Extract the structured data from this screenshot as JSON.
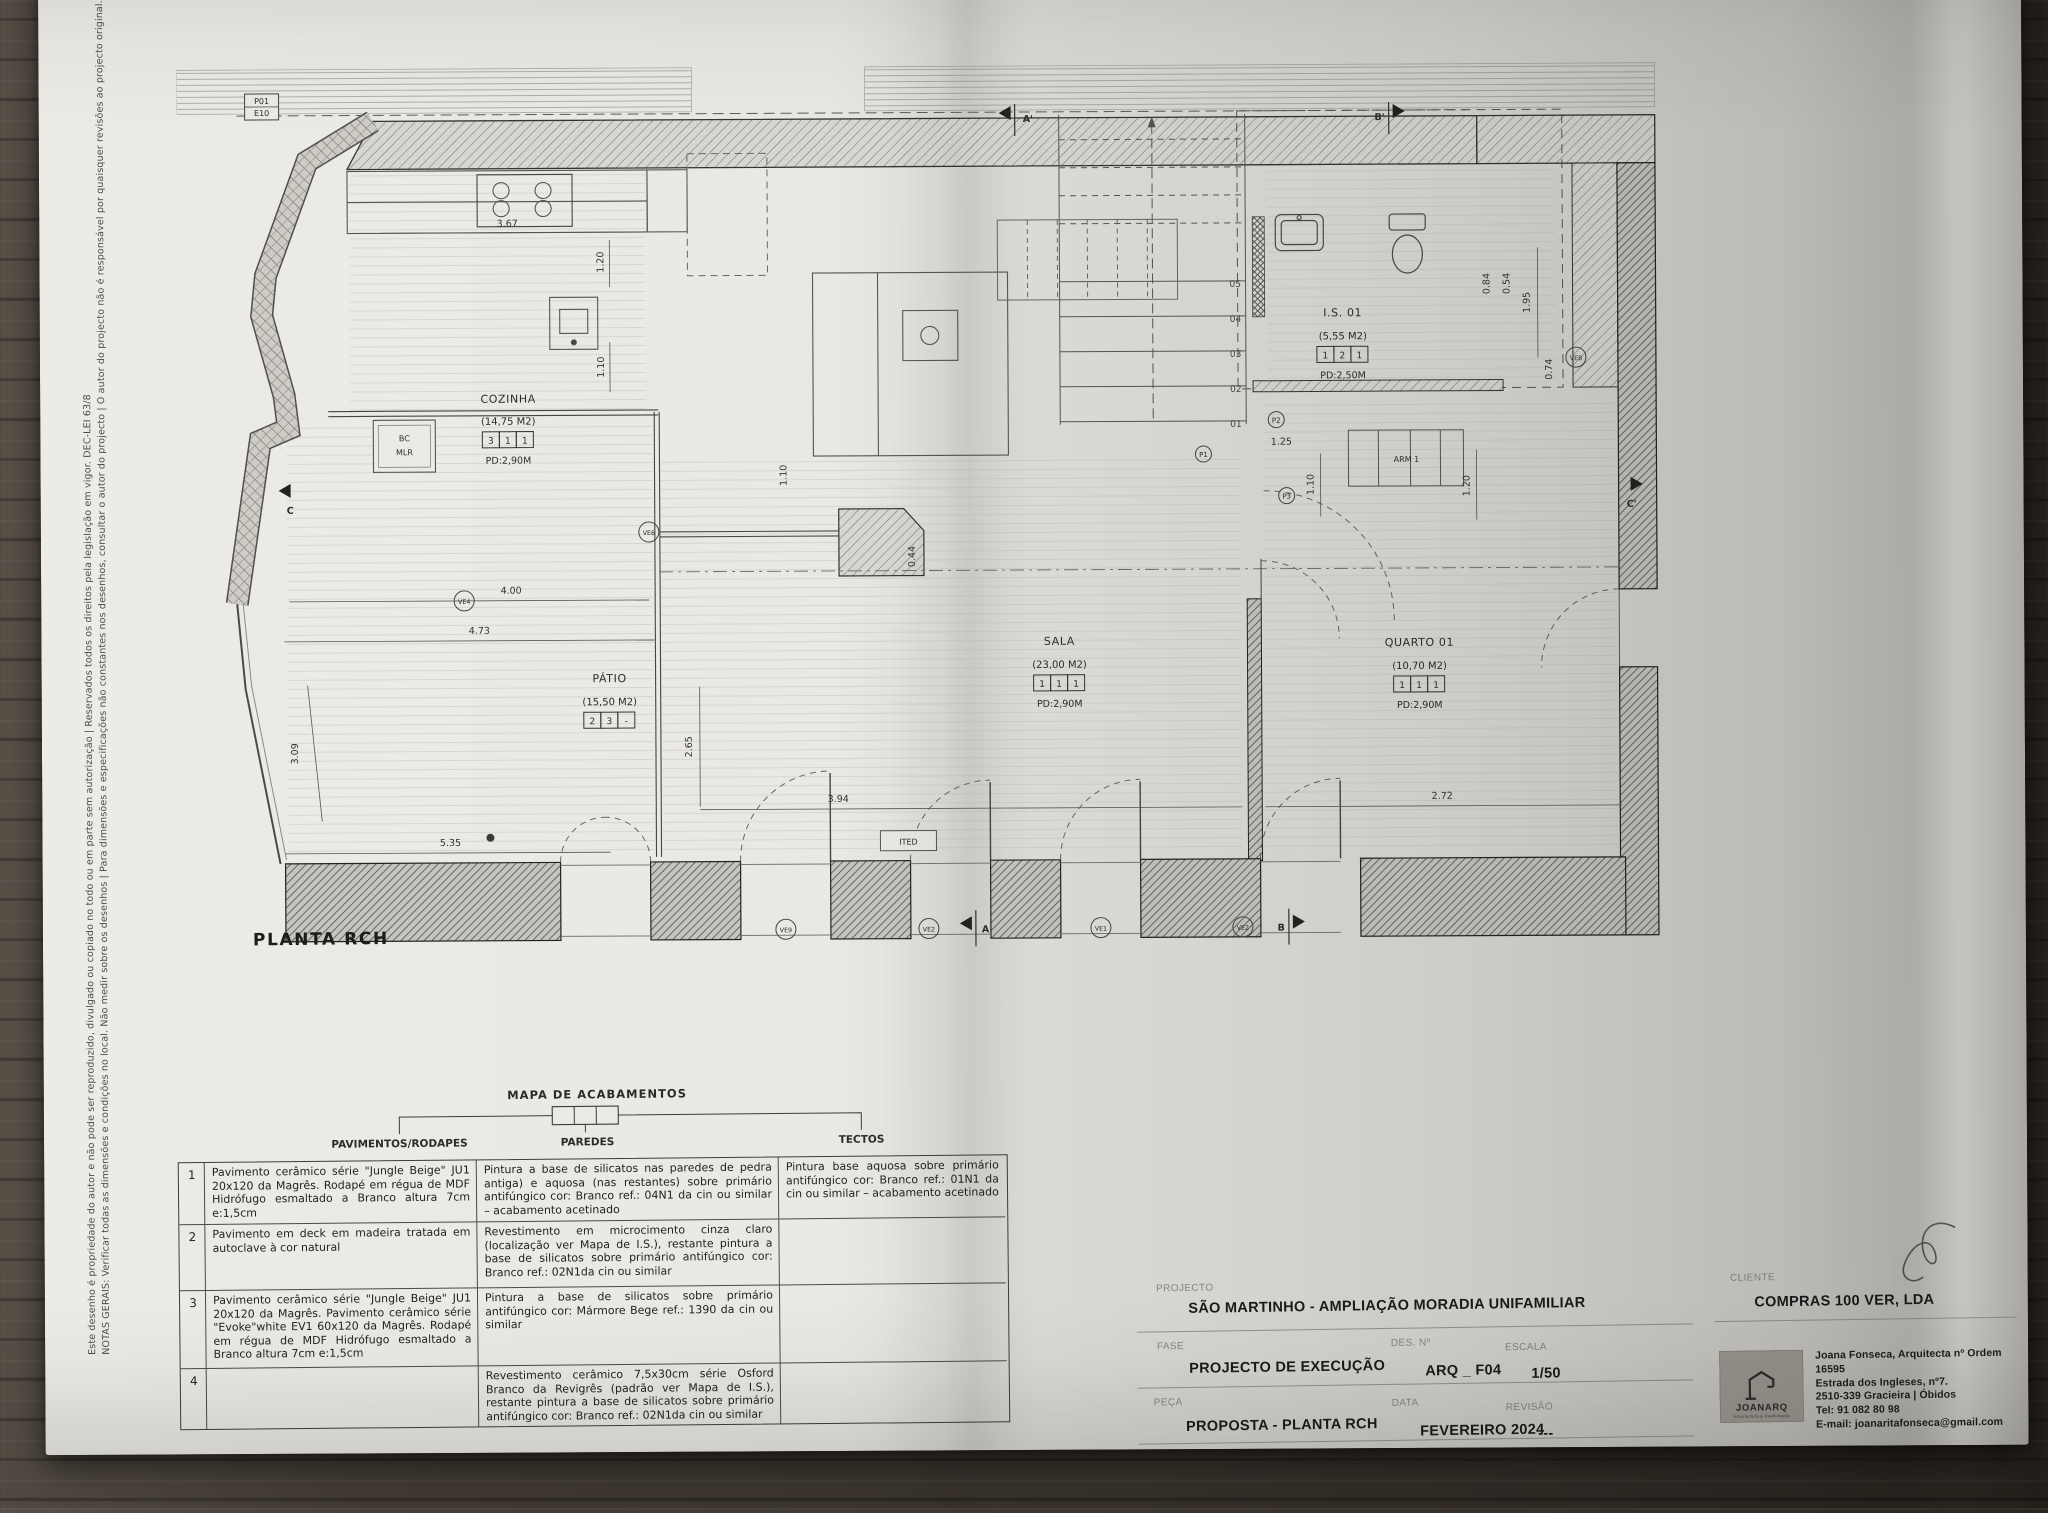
{
  "notes": {
    "line1": "NOTAS GERAIS: Verificar todas as dimensões e condições no local. Não medir sobre os desenhos | Para dimensões e especificações não constantes nos desenhos, consultar o autor do projecto | O autor do projecto não é responsável por quaisquer revisões ao projecto original.",
    "line2": "Este desenho é propriedade do autor e não pode ser reproduzido, divulgado ou copiado no todo ou em parte sem autorização | Reservados todos os direitos pela legislação em vigor. DEC-LEI 63/8"
  },
  "plan": {
    "title": "PLANTA RCH",
    "rooms": [
      {
        "name": "COZINHA",
        "area": "(14,75 M2)",
        "codes": [
          "3",
          "1",
          "1"
        ],
        "pd": "PD:2,90M"
      },
      {
        "name": "PÁTIO",
        "area": "(15,50 M2)",
        "codes": [
          "2",
          "3",
          "-"
        ],
        "pd": ""
      },
      {
        "name": "SALA",
        "area": "(23,00 M2)",
        "codes": [
          "1",
          "1",
          "1"
        ],
        "pd": "PD:2,90M"
      },
      {
        "name": "QUARTO 01",
        "area": "(10,70 M2)",
        "codes": [
          "1",
          "1",
          "1"
        ],
        "pd": "PD:2,90M"
      },
      {
        "name": "I.S. 01",
        "area": "(5,55 M2)",
        "codes": [
          "1",
          "2",
          "1"
        ],
        "pd": "PD:2,50M"
      }
    ],
    "arm_label": "ARM 1",
    "bc_label": "BC",
    "mlr_label": "MLR",
    "ited_label": "ITED",
    "dims": {
      "kitchen_w": "3.67",
      "kitchen_v1": "1.20",
      "kitchen_v2": "1.10",
      "patio_glass": "4.00",
      "patio_w": "4.73",
      "patio_h": "2.65",
      "patio_left": "3.09",
      "patio_b": "5.35",
      "sala_w": "3.94",
      "quarto_w": "2.72",
      "hall_w": "1.25",
      "hall_v": "1.10",
      "arm_v": "1.20",
      "is_v": "1.95",
      "is_d1": "0.84",
      "is_d2": "0.54",
      "is_d3": "0.74",
      "wall_d": "0.44",
      "mid_v": "1.10"
    },
    "stairs": [
      "05",
      "04",
      "03",
      "02",
      "01"
    ],
    "markers": {
      "ve4": "VE4",
      "ve6": "VE6",
      "ve8": "VE8",
      "ve9": "VE9",
      "ve2a": "VE2",
      "ve1": "VE1",
      "ve2b": "VE2",
      "p1": "P1",
      "p2": "P2",
      "p3": "P3"
    },
    "refs": {
      "p01": "P01",
      "e10": "E10",
      "p02": "P02",
      "e11": "E11"
    },
    "sections": {
      "a": "A",
      "a_prime": "A'",
      "b": "B",
      "b_prime": "B'",
      "c": "C",
      "c_prime": "C'"
    }
  },
  "finishes": {
    "title": "MAPA DE ACABAMENTOS",
    "columns": [
      "PAVIMENTOS/RODAPES",
      "PAREDES",
      "TECTOS"
    ],
    "rows": [
      {
        "num": "1",
        "pavimentos": "Pavimento cerâmico série \"Jungle Beige\" JU1 20x120 da Magrês. Rodapé em régua de MDF Hidrófugo esmaltado a Branco altura 7cm e:1,5cm",
        "paredes": "Pintura a base de silicatos nas paredes de pedra antiga) e aquosa (nas restantes) sobre primário antifúngico cor: Branco ref.: 04N1 da cin ou similar – acabamento acetinado",
        "tectos": "Pintura base aquosa sobre primário antifúngico cor: Branco ref.: 01N1 da cin ou similar – acabamento acetinado"
      },
      {
        "num": "2",
        "pavimentos": "Pavimento em deck em madeira tratada em autoclave à cor natural",
        "paredes": "Revestimento em microcimento cinza claro (localização ver Mapa de I.S.), restante pintura a base de silicatos sobre primário antifúngico cor: Branco ref.: 02N1da cin ou similar",
        "tectos": ""
      },
      {
        "num": "3",
        "pavimentos": "Pavimento cerâmico série \"Jungle Beige\" JU1 20x120 da Magrês. Pavimento cerâmico série \"Evoke\"white EV1 60x120 da Magrês. Rodapé em régua de MDF Hidrófugo esmaltado a Branco altura 7cm e:1,5cm",
        "paredes": "Pintura a base de silicatos sobre primário antifúngico cor: Mármore Bege ref.: 1390 da cin ou similar",
        "tectos": ""
      },
      {
        "num": "4",
        "pavimentos": "",
        "paredes": "Revestimento cerâmico 7,5x30cm série Osford Branco da Revigrês (padrão ver Mapa de I.S.), restante pintura a base de silicatos sobre primário antifúngico cor: Branco ref.: 02N1da cin ou similar",
        "tectos": ""
      }
    ]
  },
  "title_block": {
    "projecto_label": "PROJECTO",
    "projecto": "SÃO MARTINHO  -  AMPLIAÇÃO  MORADIA UNIFAMILIAR",
    "fase_label": "FASE",
    "fase": "PROJECTO DE EXECUÇÃO",
    "peca_label": "PEÇA",
    "peca": "PROPOSTA - PLANTA RCH",
    "des_label": "DES. Nº",
    "des": "ARQ _ F04",
    "escala_label": "ESCALA",
    "escala": "1/50",
    "data_label": "DATA",
    "data": "FEVEREIRO 2024",
    "revisao_label": "REVISÃO",
    "revisao": "---",
    "cliente_label": "CLIENTE",
    "cliente": "COMPRAS 100 VER, LDA",
    "architect": {
      "logo": "JOANARQ",
      "logo_sub": "Arquitectura & Reabilitação",
      "name": "Joana Fonseca, Arquitecta nº Ordem 16595",
      "address1": "Estrada dos Ingleses, nº7.",
      "address2": "2510-339 Gracieira | Óbidos",
      "tel": "Tel: 91 082 80 98",
      "email": "E-mail: joanaritafonseca@gmail.com"
    }
  }
}
